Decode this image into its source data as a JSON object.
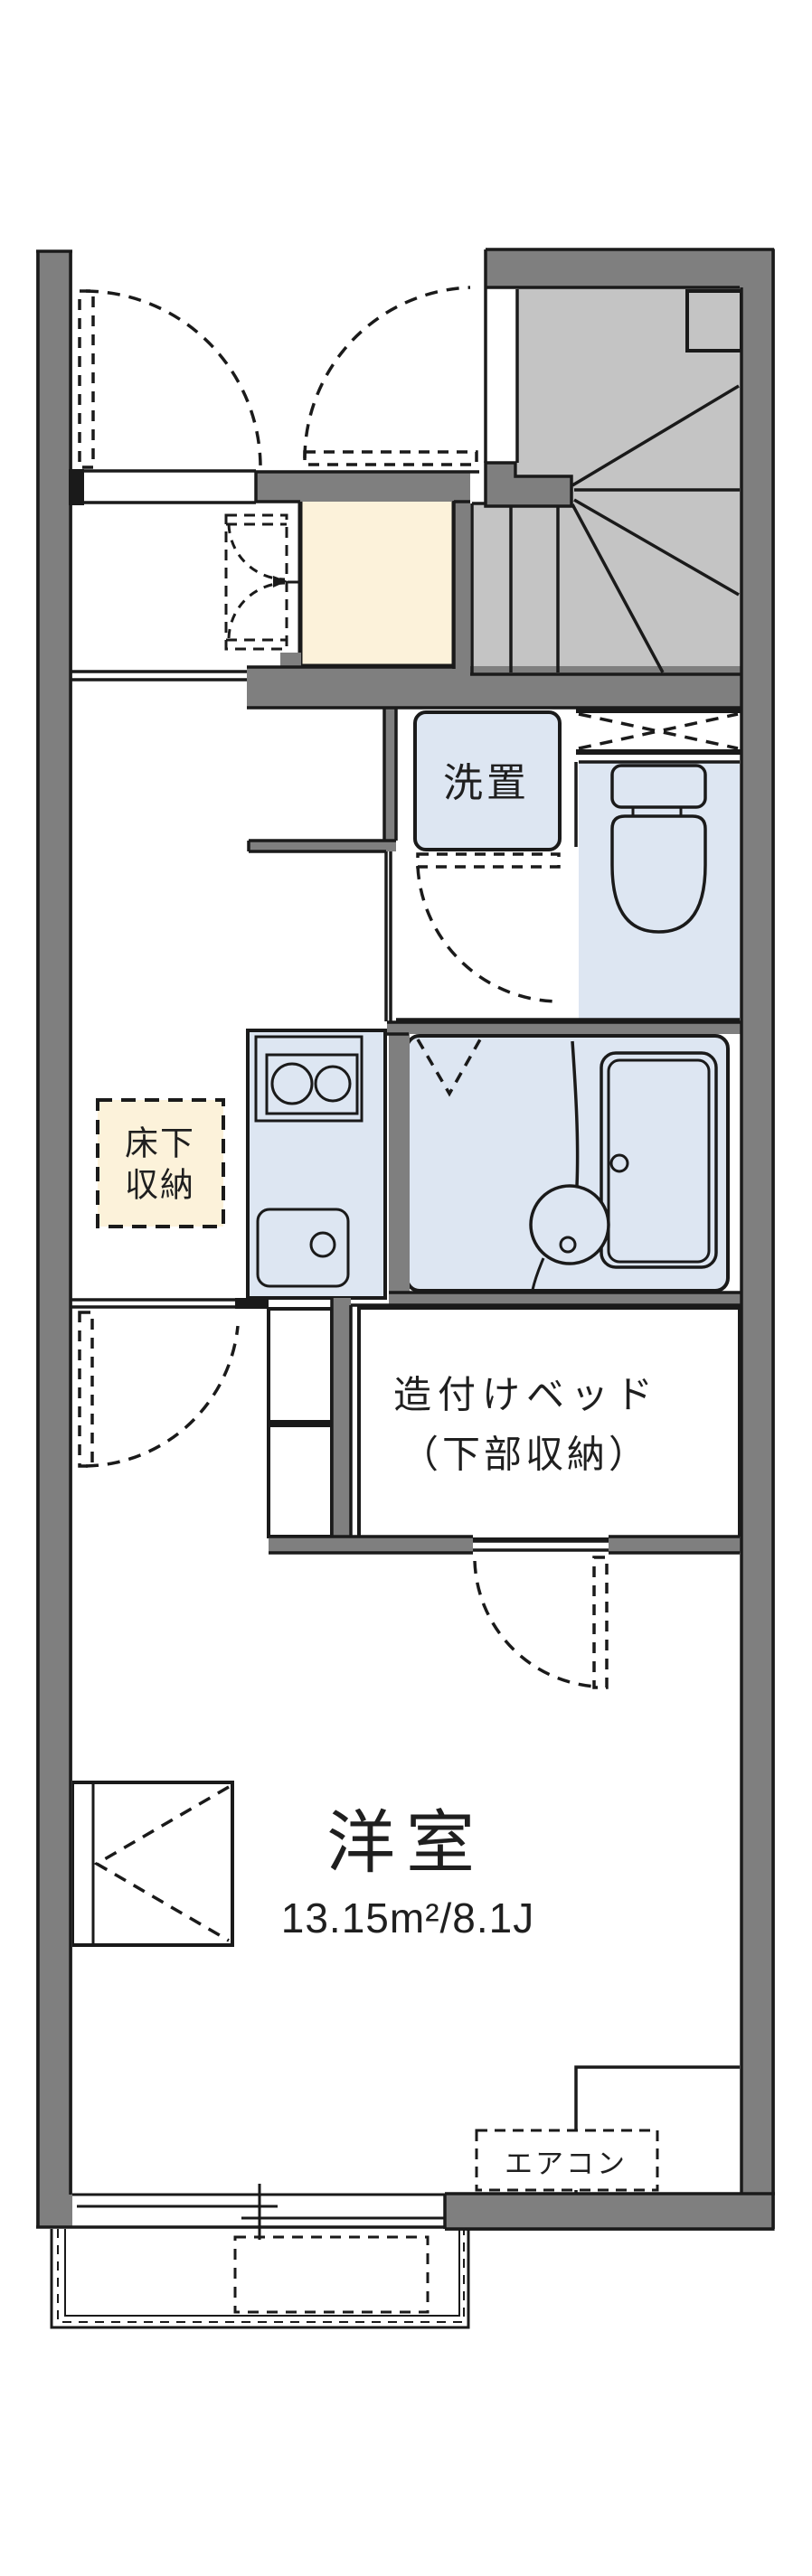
{
  "plan": {
    "type": "japanese-apartment-floorplan",
    "labels": {
      "laundry": "洗置",
      "underfloor_line1": "床下",
      "underfloor_line2": "収納",
      "bed_line1": "造付けベッド",
      "bed_line2": "（下部収納）",
      "room_name": "洋室",
      "room_size": "13.15m²/8.1J",
      "aircon": "エアコン"
    },
    "colors": {
      "wall_gray": "#7f7f7f",
      "stair_gray": "#c4c4c4",
      "fixture_blue": "#dde6f2",
      "storage_cream": "#fcf2da",
      "line_black": "#1a1a1a"
    }
  }
}
